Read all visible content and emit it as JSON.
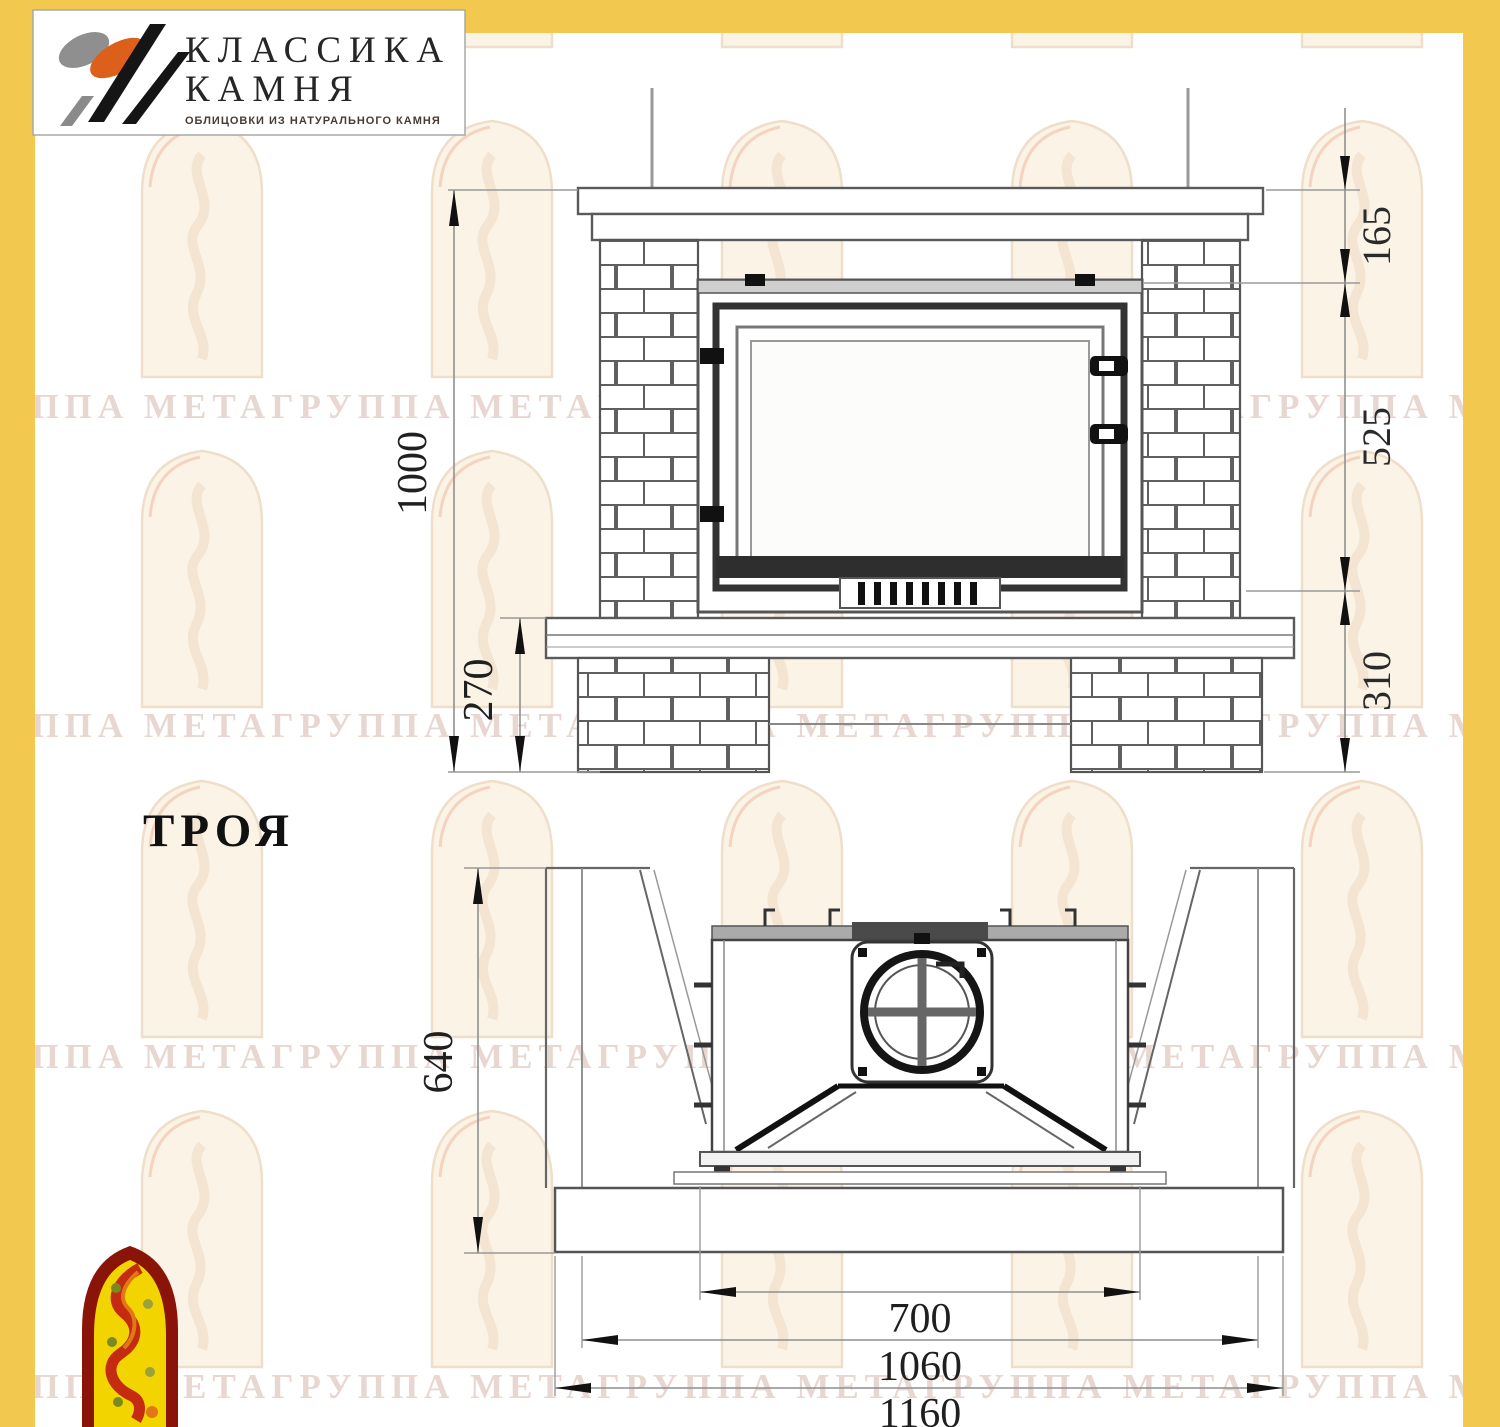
{
  "logo": {
    "title_line1": "КЛАССИКА",
    "title_line2": "КАМНЯ",
    "tagline": "ОБЛИЦОВКИ ИЗ НАТУРАЛЬНОГО КАМНЯ"
  },
  "model": {
    "name": "ТРОЯ"
  },
  "front_view": {
    "total_height": "1000",
    "plinth_height": "270",
    "top_offset": "165",
    "firebox_height": "525",
    "base_height": "310"
  },
  "plan_view": {
    "depth": "640",
    "opening_width": "700",
    "body_width": "1060",
    "overall_width": "1160"
  },
  "watermark": {
    "text": "ГРУППА МЕТАГРУППА МЕТАГРУППА МЕТАГРУППА МЕТАГРУППА МЕТА"
  },
  "colors": {
    "frame": "#F2C84E",
    "logo_orange": "#DD5F1C",
    "logo_black": "#151515",
    "logo_gray": "#8f8f8f",
    "badge_red": "#8B1408",
    "badge_yellow": "#F2D400",
    "drawing_line": "#555555",
    "dim_text": "#1f1f1f"
  }
}
